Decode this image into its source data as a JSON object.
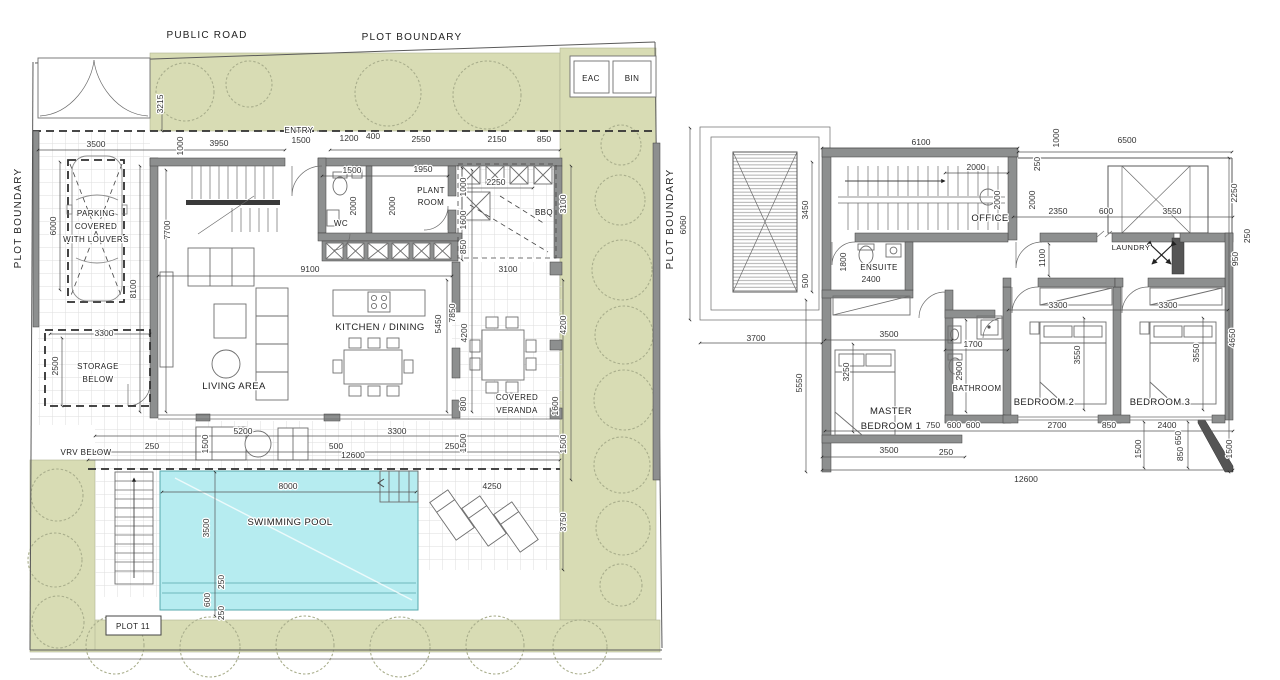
{
  "title": "Villa floor plans - Plot 11",
  "colors": {
    "greenery": "#d8dcb4",
    "pool": "#b6ecf0",
    "wall_gray": "#8d8f8f",
    "line": "#555555"
  },
  "ground_floor": {
    "site": {
      "public_road": "PUBLIC ROAD",
      "plot_boundary": "PLOT BOUNDARY",
      "entry": "ENTRY",
      "eac": "EAC",
      "bin": "BIN",
      "plot_11": "PLOT 11",
      "vrv_below": "VRV BELOW",
      "swimming_pool": "SWIMMING POOL"
    },
    "rooms": {
      "wc": "WC",
      "plant_room": [
        "PLANT",
        "ROOM"
      ],
      "bbq": "BBQ",
      "kitchen_dining": "KITCHEN / DINING",
      "living_area": "LIVING AREA",
      "covered_veranda": [
        "COVERED",
        "VERANDA"
      ],
      "parking": [
        "PARKING",
        "COVERED",
        "WITH LOUVERS"
      ],
      "storage_below": [
        "STORAGE",
        "BELOW"
      ]
    },
    "dims": [
      "3215",
      "3500",
      "1000",
      "3950",
      "1500",
      "1200",
      "400",
      "2550",
      "2150",
      "850",
      "1500",
      "1950",
      "2000",
      "2000",
      "2250",
      "1000",
      "1600",
      "850",
      "3100",
      "6000",
      "8100",
      "7700",
      "9100",
      "3100",
      "5450",
      "7850",
      "4200",
      "4200",
      "3300",
      "2500",
      "800",
      "1500",
      "1600",
      "1500",
      "3750",
      "250",
      "5200",
      "1500",
      "500",
      "12600",
      "3300",
      "250",
      "4250",
      "8000",
      "3500",
      "250",
      "600",
      "250"
    ]
  },
  "first_floor": {
    "rooms": {
      "office": "OFFICE",
      "ensuite": "ENSUITE",
      "laundry": "LAUNDRY",
      "bathroom": "BATHROOM",
      "master_bedroom": [
        "MASTER",
        "BEDROOM 1"
      ],
      "bedroom2": "BEDROOM 2",
      "bedroom3": "BEDROOM 3"
    },
    "dims": [
      "6060",
      "6100",
      "3450",
      "500",
      "2000",
      "250",
      "1000",
      "6500",
      "2000",
      "2000",
      "2350",
      "600",
      "3550",
      "2250",
      "250",
      "950",
      "1800",
      "2400",
      "1100",
      "3700",
      "5550",
      "3500",
      "3250",
      "1700",
      "2900",
      "3300",
      "3300",
      "3550",
      "3550",
      "4650",
      "3500",
      "250",
      "750",
      "600",
      "600",
      "2700",
      "850",
      "2400",
      "650",
      "850",
      "1500",
      "1500",
      "12600"
    ]
  }
}
